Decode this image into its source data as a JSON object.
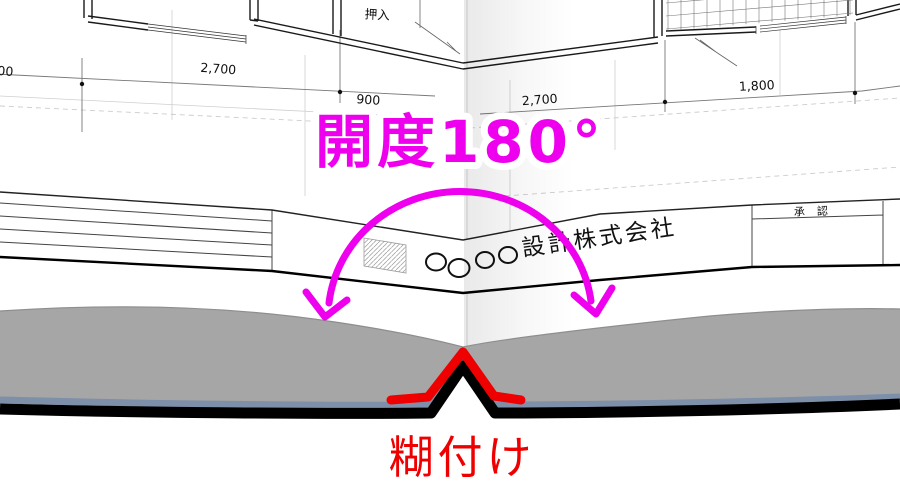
{
  "labels": {
    "opening": "開度180°",
    "glue": "糊付け"
  },
  "plan": {
    "closet": "押入",
    "dims": {
      "left_clipped": "00",
      "top_left": "2,700",
      "mid_clipped": "900",
      "right_mid_clipped": "2,700",
      "top_right": "1,800"
    }
  },
  "title_block": {
    "company": "設計株式会社",
    "approval": "承認",
    "logo_circle_count": 4
  },
  "colors": {
    "magenta": "#ee00ee",
    "red": "#ee0000",
    "page_edge_gray": "#a6a6a6",
    "cover_slate": "#7e8fa9",
    "cover_black": "#000000"
  }
}
